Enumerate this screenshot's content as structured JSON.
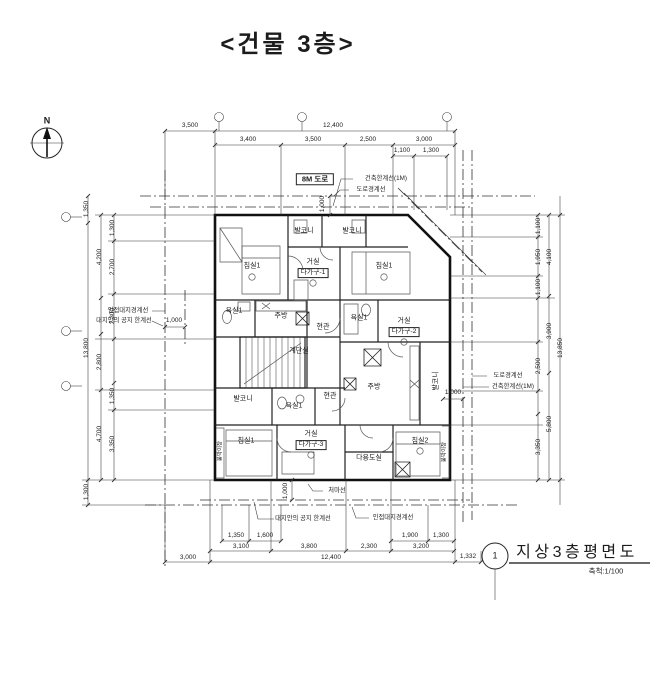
{
  "title": "<건물 3층>",
  "north": {
    "label": "N"
  },
  "road_label": "8M 도로",
  "annotations": {
    "bldg_limit_top": "건축한계선(1M)",
    "road_boundary_top": "도로경계선",
    "adjacent_boundary_left": "인접대지경계선",
    "open_space_left": "대지안의 공지 한계선",
    "road_boundary_right": "도로경계선",
    "bldg_limit_right": "건축한계선(1M)",
    "open_space_bottom": "대지안의 공지 한계선",
    "adjacent_boundary_bottom": "인접대지경계선",
    "eaves_label": "처마선"
  },
  "rooms": {
    "bedroom1_tl": "침실1",
    "balcony_top1": "발코니",
    "balcony_top2": "발코니",
    "living1": "거실",
    "unit1": "다가구-1",
    "bedroom1_tr": "침실1",
    "bath1_u1": "욕실1",
    "kitchen_u1": "주방",
    "entry_u1": "현관",
    "bath1_u2": "욕실1",
    "living2": "거실",
    "unit2": "다가구-2",
    "stair": "계단실",
    "balcony_left": "발코니",
    "bath1_u3": "욕실1",
    "entry_u3": "현관",
    "kitchen_u2": "주방",
    "balcony_right": "발코니",
    "bedroom1_bl": "침실1",
    "living3": "거실",
    "unit3": "다가구-3",
    "utility": "다용도실",
    "bedroom2_br": "침실2",
    "closet_left": "붙박이장",
    "closet_right": "붙박이장"
  },
  "dims": {
    "top": {
      "a": "3,500",
      "b": "12,400",
      "c": "3,400",
      "d": "3,500",
      "e": "2,500",
      "f": "3,000",
      "g": "1,100",
      "h": "1,300",
      "v1000": "1,000"
    },
    "left": {
      "a": "1,350",
      "b": "13,800",
      "c": "1,300",
      "d": "4,200",
      "e": "2,800",
      "f": "4,700",
      "g": "1,300",
      "h": "2,700",
      "i": "2,300",
      "j": "1,350",
      "k": "3,350",
      "h1000": "1,000"
    },
    "right": {
      "a": "1,100",
      "b": "1,950",
      "c": "1,100",
      "d": "2,500",
      "e": "3,350",
      "f": "4,100",
      "g": "3,900",
      "h": "5,800",
      "i": "13,850",
      "h1000": "1,000"
    },
    "bottom": {
      "a": "1,350",
      "b": "1,600",
      "c": "1,900",
      "d": "1,300",
      "e": "3,100",
      "f": "3,800",
      "g": "2,300",
      "h": "3,200",
      "i": "1,332",
      "j": "3,000",
      "k": "12,400",
      "v1000": "1,000"
    }
  },
  "titleblock": {
    "number": "1",
    "name": "지상3층평면도",
    "scale": "축척:1/100"
  }
}
